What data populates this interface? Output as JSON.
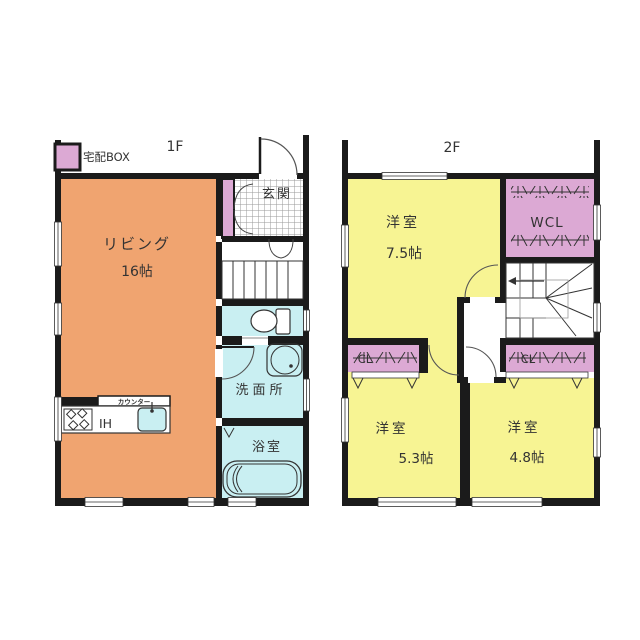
{
  "colors": {
    "living": "#F0A470",
    "wet_room": "#C9EFF2",
    "bedroom": "#F7F493",
    "closet": "#DCA9D4",
    "wall": "#1b1b1b"
  },
  "floor1": {
    "label": "1F",
    "delivery_box_label": "宅配BOX",
    "living_name": "リビング",
    "living_size": "16帖",
    "entrance": "玄関",
    "counter": "カウンター",
    "ih": "IH",
    "washroom": "洗面所",
    "bathroom": "浴室"
  },
  "floor2": {
    "label": "2F",
    "room_a_name": "洋室",
    "room_a_size": "7.5帖",
    "wcl": "WCL",
    "cl_left": "CL",
    "cl_right": "CL",
    "room_b_name": "洋室",
    "room_b_size": "5.3帖",
    "room_c_name": "洋室",
    "room_c_size": "4.8帖"
  }
}
